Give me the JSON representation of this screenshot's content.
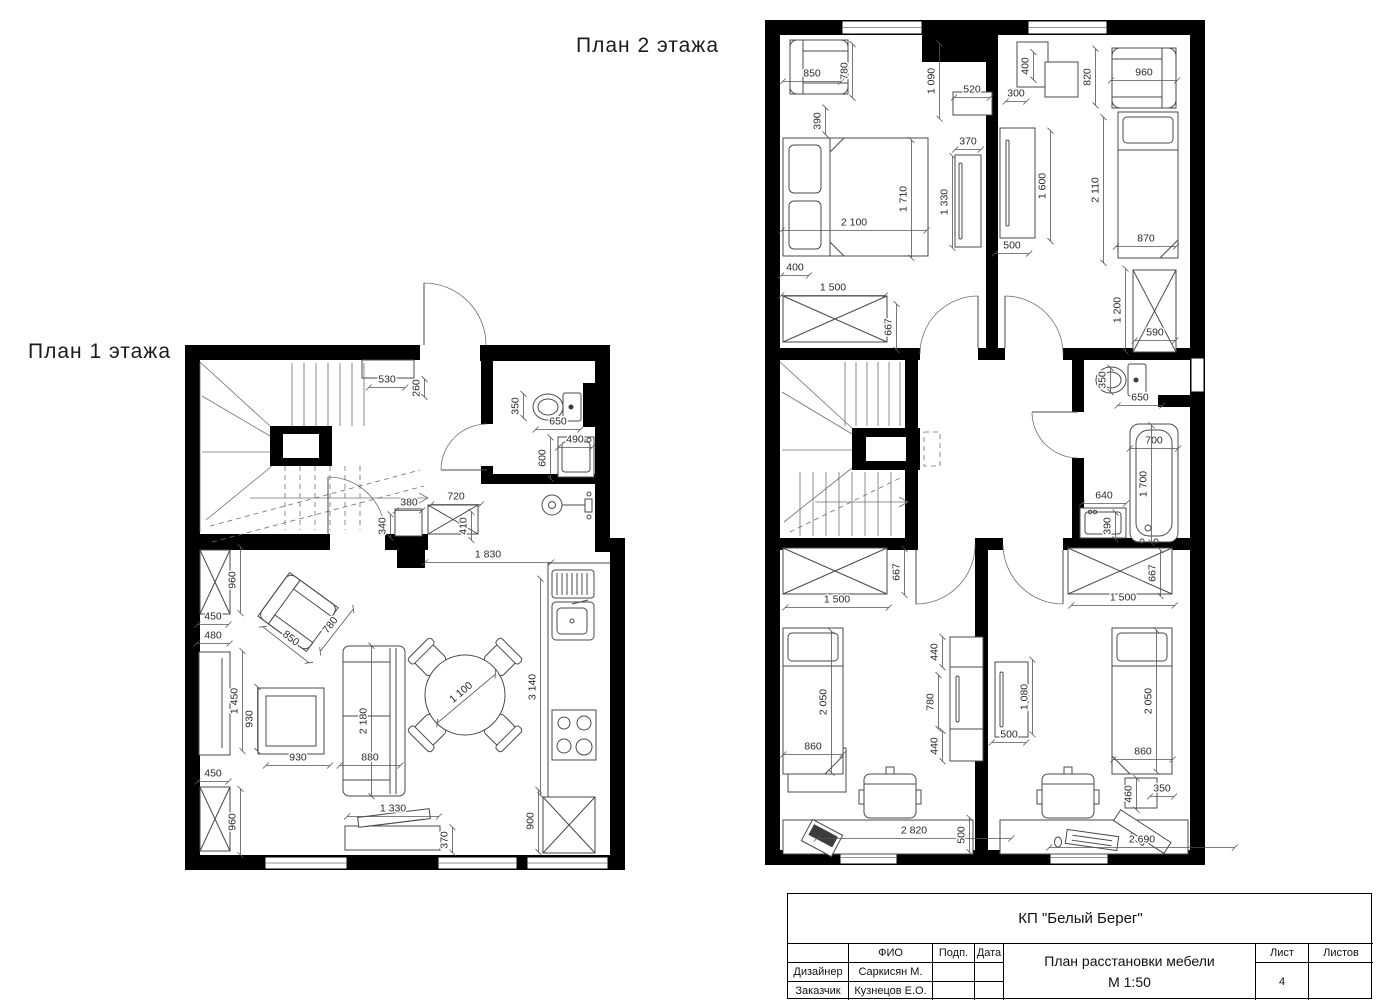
{
  "titles": {
    "floor1": "План 1 этажа",
    "floor2": "План 2 этажа"
  },
  "titleblock": {
    "project": "КП \"Белый Берег\"",
    "col_fio": "ФИО",
    "col_podp": "Подп.",
    "col_data": "Дата",
    "row1_role": "Дизайнер",
    "row1_name": "Саркисян М.",
    "row2_role": "Заказчик",
    "row2_name": "Кузнецов Е.О.",
    "doc_title": "План расстановки мебели",
    "doc_scale": "М 1:50",
    "sheet_label": "Лист",
    "sheets_label": "Листов",
    "sheet_number": "4",
    "sheets_total": ""
  },
  "dims_floor1": [
    {
      "t": "530",
      "x": 387,
      "y": 384,
      "r": 0
    },
    {
      "t": "260",
      "x": 421,
      "y": 388,
      "r": -90
    },
    {
      "t": "350",
      "x": 520,
      "y": 406,
      "r": -90
    },
    {
      "t": "650",
      "x": 558,
      "y": 426,
      "r": 0
    },
    {
      "t": "490",
      "x": 575,
      "y": 444,
      "r": 0
    },
    {
      "t": "600",
      "x": 547,
      "y": 458,
      "r": -90
    },
    {
      "t": "380",
      "x": 409,
      "y": 507,
      "r": 0
    },
    {
      "t": "720",
      "x": 456,
      "y": 501,
      "r": 0
    },
    {
      "t": "340",
      "x": 387,
      "y": 526,
      "r": -90
    },
    {
      "t": "410",
      "x": 468,
      "y": 526,
      "r": -90
    },
    {
      "t": "1 830",
      "x": 488,
      "y": 559,
      "r": 0
    },
    {
      "t": "960",
      "x": 237,
      "y": 580,
      "r": -90
    },
    {
      "t": "450",
      "x": 213,
      "y": 621,
      "r": 0
    },
    {
      "t": "480",
      "x": 213,
      "y": 640,
      "r": 0
    },
    {
      "t": "850",
      "x": 288,
      "y": 642,
      "r": 38
    },
    {
      "t": "780",
      "x": 334,
      "y": 628,
      "r": -52
    },
    {
      "t": "1 450",
      "x": 239,
      "y": 701,
      "r": -90
    },
    {
      "t": "930",
      "x": 254,
      "y": 719,
      "r": -90
    },
    {
      "t": "930",
      "x": 298,
      "y": 762,
      "r": 0
    },
    {
      "t": "2 180",
      "x": 368,
      "y": 721,
      "r": -90
    },
    {
      "t": "880",
      "x": 370,
      "y": 762,
      "r": 0
    },
    {
      "t": "1 100",
      "x": 464,
      "y": 696,
      "r": -40
    },
    {
      "t": "3 140",
      "x": 537,
      "y": 687,
      "r": -90
    },
    {
      "t": "450",
      "x": 213,
      "y": 778,
      "r": 0
    },
    {
      "t": "960",
      "x": 237,
      "y": 822,
      "r": -90
    },
    {
      "t": "1 330",
      "x": 393,
      "y": 813,
      "r": 0
    },
    {
      "t": "370",
      "x": 449,
      "y": 840,
      "r": -90
    },
    {
      "t": "900",
      "x": 535,
      "y": 821,
      "r": -90
    }
  ],
  "dims_floor2": [
    {
      "t": "850",
      "x": 812,
      "y": 78,
      "r": 0
    },
    {
      "t": "780",
      "x": 849,
      "y": 71,
      "r": -90
    },
    {
      "t": "390",
      "x": 822,
      "y": 121,
      "r": -90
    },
    {
      "t": "1 090",
      "x": 936,
      "y": 81,
      "r": -90
    },
    {
      "t": "520",
      "x": 972,
      "y": 94,
      "r": 0
    },
    {
      "t": "300",
      "x": 1016,
      "y": 98,
      "r": 0
    },
    {
      "t": "400",
      "x": 1030,
      "y": 66,
      "r": -90
    },
    {
      "t": "820",
      "x": 1092,
      "y": 77,
      "r": -90
    },
    {
      "t": "960",
      "x": 1144,
      "y": 77,
      "r": 0
    },
    {
      "t": "2 100",
      "x": 854,
      "y": 227,
      "r": 0
    },
    {
      "t": "1 710",
      "x": 908,
      "y": 199,
      "r": -90
    },
    {
      "t": "1 330",
      "x": 949,
      "y": 202,
      "r": -90
    },
    {
      "t": "370",
      "x": 968,
      "y": 146,
      "r": 0
    },
    {
      "t": "1 600",
      "x": 1047,
      "y": 186,
      "r": -90
    },
    {
      "t": "500",
      "x": 1012,
      "y": 250,
      "r": 0
    },
    {
      "t": "2 110",
      "x": 1100,
      "y": 190,
      "r": -90
    },
    {
      "t": "870",
      "x": 1146,
      "y": 243,
      "r": 0
    },
    {
      "t": "400",
      "x": 795,
      "y": 272,
      "r": 0
    },
    {
      "t": "1 500",
      "x": 833,
      "y": 292,
      "r": 0
    },
    {
      "t": "667",
      "x": 893,
      "y": 327,
      "r": -90
    },
    {
      "t": "1 200",
      "x": 1122,
      "y": 310,
      "r": -90
    },
    {
      "t": "590",
      "x": 1155,
      "y": 337,
      "r": 0
    },
    {
      "t": "350",
      "x": 1107,
      "y": 380,
      "r": -90
    },
    {
      "t": "650",
      "x": 1140,
      "y": 402,
      "r": 0
    },
    {
      "t": "700",
      "x": 1154,
      "y": 445,
      "r": 0
    },
    {
      "t": "1 700",
      "x": 1148,
      "y": 484,
      "r": -90
    },
    {
      "t": "640",
      "x": 1104,
      "y": 500,
      "r": 0
    },
    {
      "t": "390",
      "x": 1112,
      "y": 526,
      "r": -90
    },
    {
      "t": "1 500",
      "x": 837,
      "y": 604,
      "r": 0
    },
    {
      "t": "667",
      "x": 901,
      "y": 572,
      "r": -90
    },
    {
      "t": "1 500",
      "x": 1123,
      "y": 602,
      "r": 0
    },
    {
      "t": "667",
      "x": 1157,
      "y": 573,
      "r": -90
    },
    {
      "t": "2 050",
      "x": 828,
      "y": 702,
      "r": -90
    },
    {
      "t": "860",
      "x": 813,
      "y": 751,
      "r": 0
    },
    {
      "t": "440",
      "x": 939,
      "y": 652,
      "r": -90
    },
    {
      "t": "780",
      "x": 935,
      "y": 702,
      "r": -90
    },
    {
      "t": "440",
      "x": 939,
      "y": 746,
      "r": -90
    },
    {
      "t": "1 080",
      "x": 1029,
      "y": 697,
      "r": -90
    },
    {
      "t": "500",
      "x": 1009,
      "y": 739,
      "r": 0
    },
    {
      "t": "2 050",
      "x": 1153,
      "y": 701,
      "r": -90
    },
    {
      "t": "860",
      "x": 1143,
      "y": 756,
      "r": 0
    },
    {
      "t": "460",
      "x": 1133,
      "y": 794,
      "r": -90
    },
    {
      "t": "350",
      "x": 1162,
      "y": 793,
      "r": 0
    },
    {
      "t": "2 820",
      "x": 914,
      "y": 835,
      "r": 0
    },
    {
      "t": "500",
      "x": 966,
      "y": 835,
      "r": -90
    },
    {
      "t": "2 690",
      "x": 1142,
      "y": 844,
      "r": 0
    }
  ]
}
